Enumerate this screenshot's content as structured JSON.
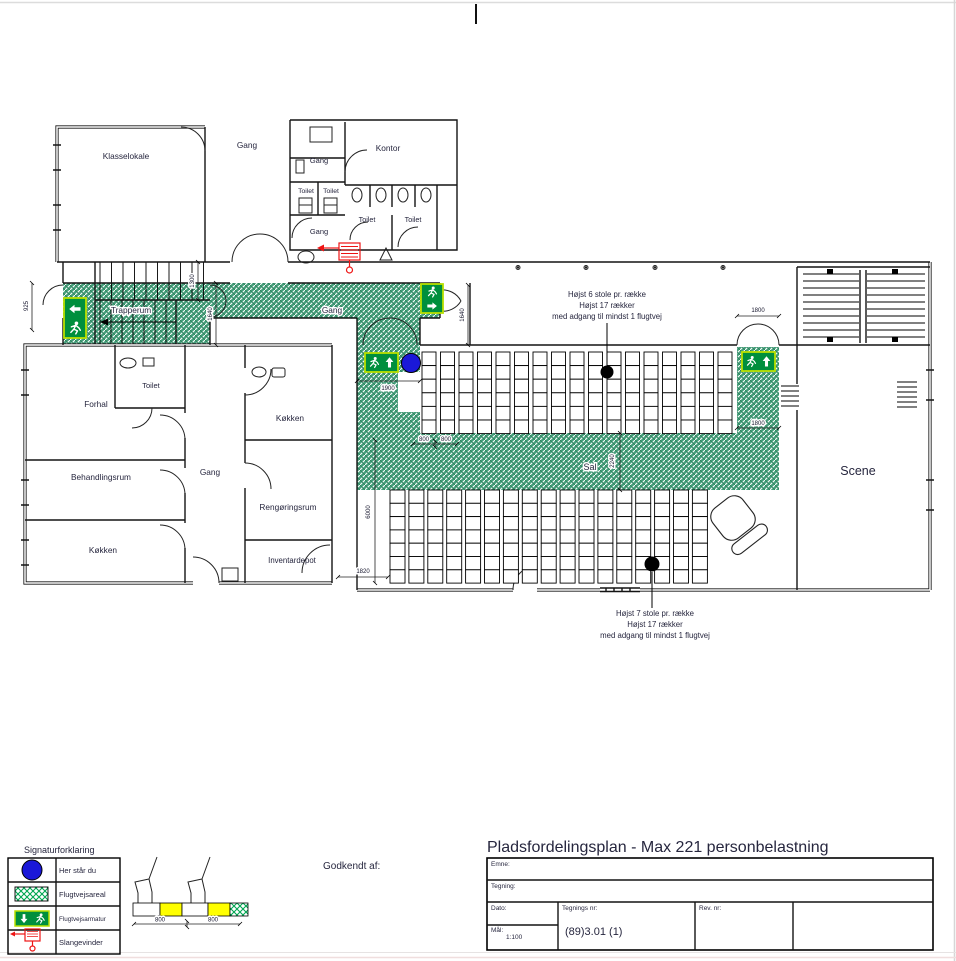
{
  "page": {
    "title_red": "Pladsfordelingsplan - Max 221 personbelastning",
    "approved_label": "Godkendt af:"
  },
  "rooms": {
    "klasselokale": "Klasselokale",
    "gang_top": "Gang",
    "kontor": "Kontor",
    "gang_small": "Gang",
    "toilet_a": "Toilet",
    "toilet_b": "Toilet",
    "toilet_c": "Toilet",
    "toilet_d": "Toilet",
    "gang_wc": "Gang",
    "trapperum": "Trapperum",
    "gang_corridor": "Gang",
    "toilet_forhal": "Toilet",
    "forhal": "Forhal",
    "koekken_right": "Køkken",
    "behandlingsrum": "Behandlingsrum",
    "gang_left": "Gang",
    "rengoeringsrum": "Rengøringsrum",
    "koekken_bottom": "Køkken",
    "inventardepot": "Inventardepot",
    "sal": "Sal",
    "scene": "Scene"
  },
  "notes": {
    "upper": [
      "Højst 6 stole pr. række",
      "Højst 17 rækker",
      "med adgang til mindst 1 flugtvej"
    ],
    "lower": [
      "Højst 7 stole pr. række",
      "Højst 17 rækker",
      "med adgang til mindst 1 flugtvej"
    ]
  },
  "dims": {
    "d925": "925",
    "d1300": "1300",
    "d1640_a": "1640",
    "d1640_b": "1640",
    "d1900": "1900",
    "d1800_door": "1800",
    "d1800_strip": "1800",
    "d2240": "2240",
    "d6000": "6000",
    "d1820": "1820",
    "d800_a": "800",
    "d800_b": "800",
    "d800_l1": "800",
    "d800_l2": "800"
  },
  "legend": {
    "title": "Signaturforklaring",
    "items": [
      {
        "icon": "you-are-here-dot",
        "label": "Her står du"
      },
      {
        "icon": "escape-area-swatch",
        "label": "Flugtvejsareal"
      },
      {
        "icon": "exit-sign",
        "label": "Flugtvejsarmatur"
      },
      {
        "icon": "hose-reel",
        "label": "Slangevinder"
      }
    ]
  },
  "titleblock": {
    "emne_label": "Emne:",
    "tegning_label": "Tegning:",
    "dato_label": "Dato:",
    "tegnings_nr_label": "Tegnings nr:",
    "tegnings_nr_value": "(89)3.01 (1)",
    "rev_nr_label": "Rev. nr:",
    "maal_label": "Mål:",
    "maal_value": "1:100"
  },
  "colors": {
    "escape_green": "#45a17b",
    "exit_sign_green": "#008f3d",
    "exit_sign_border": "#b9e000",
    "you_are_here_blue": "#1a18d8",
    "hose_red": "#ee1414",
    "title_red": "#f60d0d",
    "chair_yellow": "#ffff00"
  },
  "plan": {
    "seat_blocks": [
      {
        "id": "seat-block-upper",
        "x": 422,
        "y": 352,
        "cols": 17,
        "rows": 6,
        "pitch": 18.5,
        "w": 14,
        "cell_h": 13.6
      },
      {
        "id": "seat-block-lower",
        "x": 390,
        "y": 490,
        "cols": 17,
        "rows": 7,
        "pitch": 18.9,
        "w": 15,
        "cell_h": 13.3
      }
    ],
    "stairs": [
      {
        "id": "trapperum-upper-flight",
        "x1": 100,
        "y1": 262,
        "x2": 100,
        "y2": 300,
        "n": 10,
        "dx": 11.5,
        "dy": 0
      },
      {
        "id": "trapperum-lower-flight",
        "x1": 100,
        "y1": 300,
        "x2": 100,
        "y2": 345,
        "n": 7,
        "dx": 11,
        "dy": 0
      },
      {
        "id": "outdoor-stair-left",
        "x1": 803,
        "y1": 274,
        "x2": 859,
        "y2": 274,
        "n": 10,
        "dx": 0,
        "dy": 7
      },
      {
        "id": "outdoor-stair-right",
        "x1": 867,
        "y1": 274,
        "x2": 925,
        "y2": 274,
        "n": 10,
        "dx": 0,
        "dy": 7
      },
      {
        "id": "stage-step-left",
        "x1": 781,
        "y1": 386,
        "x2": 799,
        "y2": 386,
        "n": 5,
        "dx": 0,
        "dy": 5
      },
      {
        "id": "stage-step-right",
        "x1": 897,
        "y1": 382,
        "x2": 917,
        "y2": 382,
        "n": 6,
        "dx": 0,
        "dy": 5
      }
    ]
  }
}
